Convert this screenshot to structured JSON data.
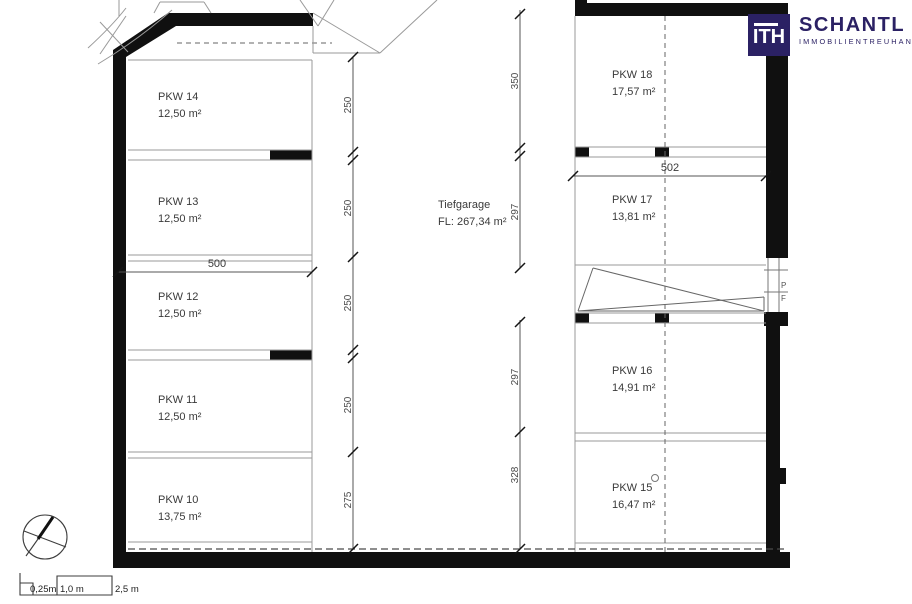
{
  "logo": {
    "monogram": "ITH",
    "name": "SCHANTL",
    "subtitle": "IMMOBILIENTREUHAND",
    "brand_color": "#2b2164"
  },
  "plan": {
    "title": "Tiefgarage",
    "area_label": "FL: 267,34 m²",
    "stalls_left": [
      {
        "name": "PKW 14",
        "area": "12,50 m²"
      },
      {
        "name": "PKW 13",
        "area": "12,50 m²"
      },
      {
        "name": "PKW 12",
        "area": "12,50 m²"
      },
      {
        "name": "PKW 11",
        "area": "12,50 m²"
      },
      {
        "name": "PKW 10",
        "area": "13,75 m²"
      }
    ],
    "stalls_right": [
      {
        "name": "PKW 18",
        "area": "17,57 m²"
      },
      {
        "name": "PKW 17",
        "area": "13,81 m²"
      },
      {
        "name": "PKW 16",
        "area": "14,91 m²"
      },
      {
        "name": "PKW 15",
        "area": "16,47 m²"
      }
    ],
    "dims_left": [
      "250",
      "250",
      "250",
      "250",
      "275"
    ],
    "dims_mid_upper": [
      "350",
      "297"
    ],
    "dims_mid_lower": [
      "297",
      "328"
    ],
    "dim_width_left": "500",
    "dim_width_right": "502",
    "edge_text_1": "P",
    "edge_text_2": "F"
  },
  "scalebar": {
    "label_1": "0,25m",
    "label_2": "1,0 m",
    "label_3": "2,5 m"
  }
}
